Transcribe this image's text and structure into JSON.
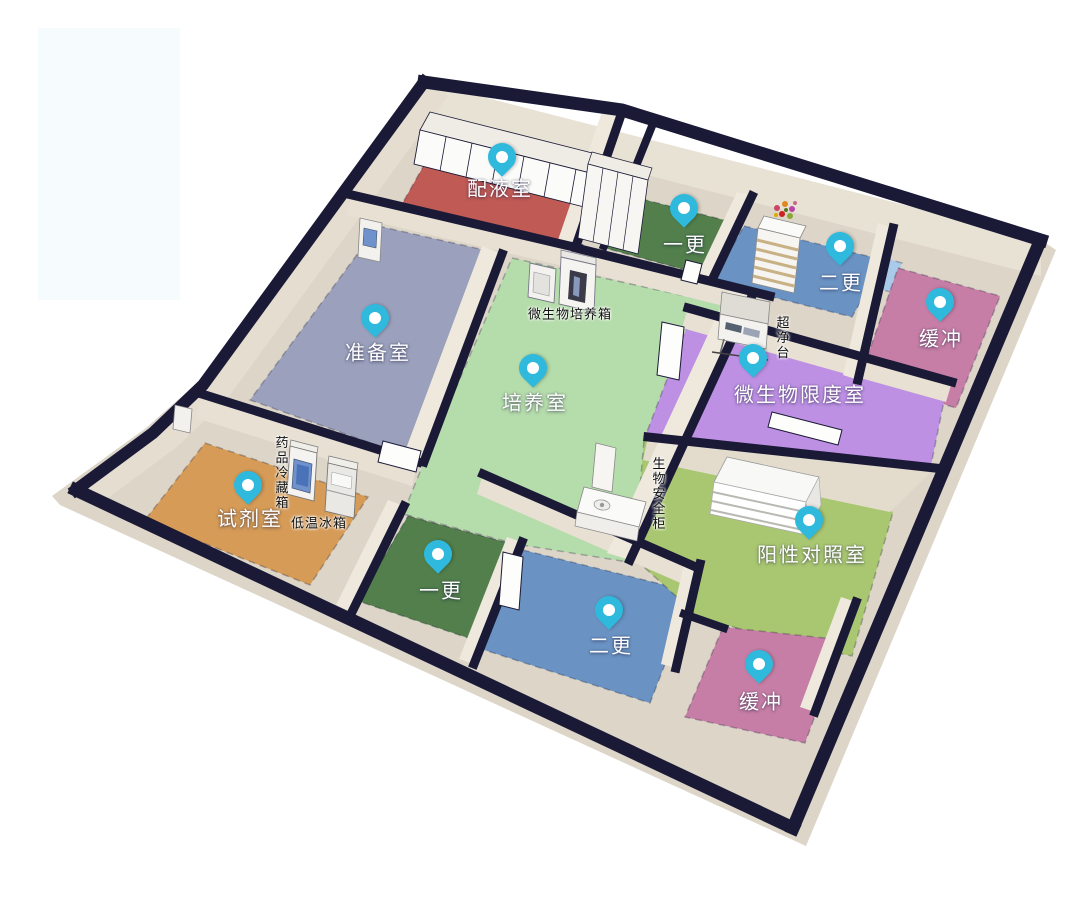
{
  "colors": {
    "pin": "#2fb9dc",
    "pin_center": "#ffffff",
    "wall_top": "#1a1a36",
    "wall_face": "#e3dccf",
    "ground": "#dcd5c8",
    "room_label_text": "#ffffff",
    "equipment_label_text": "#101010"
  },
  "rooms": {
    "peiyeshi": {
      "label": "配液室",
      "color": "#c05a55"
    },
    "yigeng_top": {
      "label": "一更",
      "color": "#527f4c"
    },
    "ergeng_top": {
      "label": "二更",
      "color": "#6a93c3"
    },
    "huanchong_top": {
      "label": "缓冲",
      "color": "#c67ea6"
    },
    "zhunbeishi": {
      "label": "准备室",
      "color": "#9ba1bc"
    },
    "peiyangshi": {
      "label": "培养室",
      "color": "#b5dcab"
    },
    "weishengwu_xiandushi": {
      "label": "微生物限度室",
      "color": "#bd90e3"
    },
    "shijishi": {
      "label": "试剂室",
      "color": "#d59b57"
    },
    "yigeng_bottom": {
      "label": "一更",
      "color": "#527f4c"
    },
    "ergeng_bottom": {
      "label": "二更",
      "color": "#6a93c3"
    },
    "yangxing_duizhaoshi": {
      "label": "阳性对照室",
      "color": "#a9c771"
    },
    "huanchong_bottom": {
      "label": "缓冲",
      "color": "#c67ea6"
    },
    "passbox": {
      "label": "",
      "color": "#a9cbe9"
    }
  },
  "equipment": {
    "incubator": {
      "label": "微生物培养箱"
    },
    "clean_bench": {
      "label": "超净台"
    },
    "medicine_fridge": {
      "label": "药品冷藏箱"
    },
    "freezer": {
      "label": "低温冰箱"
    },
    "biosafety_cabinet": {
      "label": "生物安全柜"
    }
  }
}
